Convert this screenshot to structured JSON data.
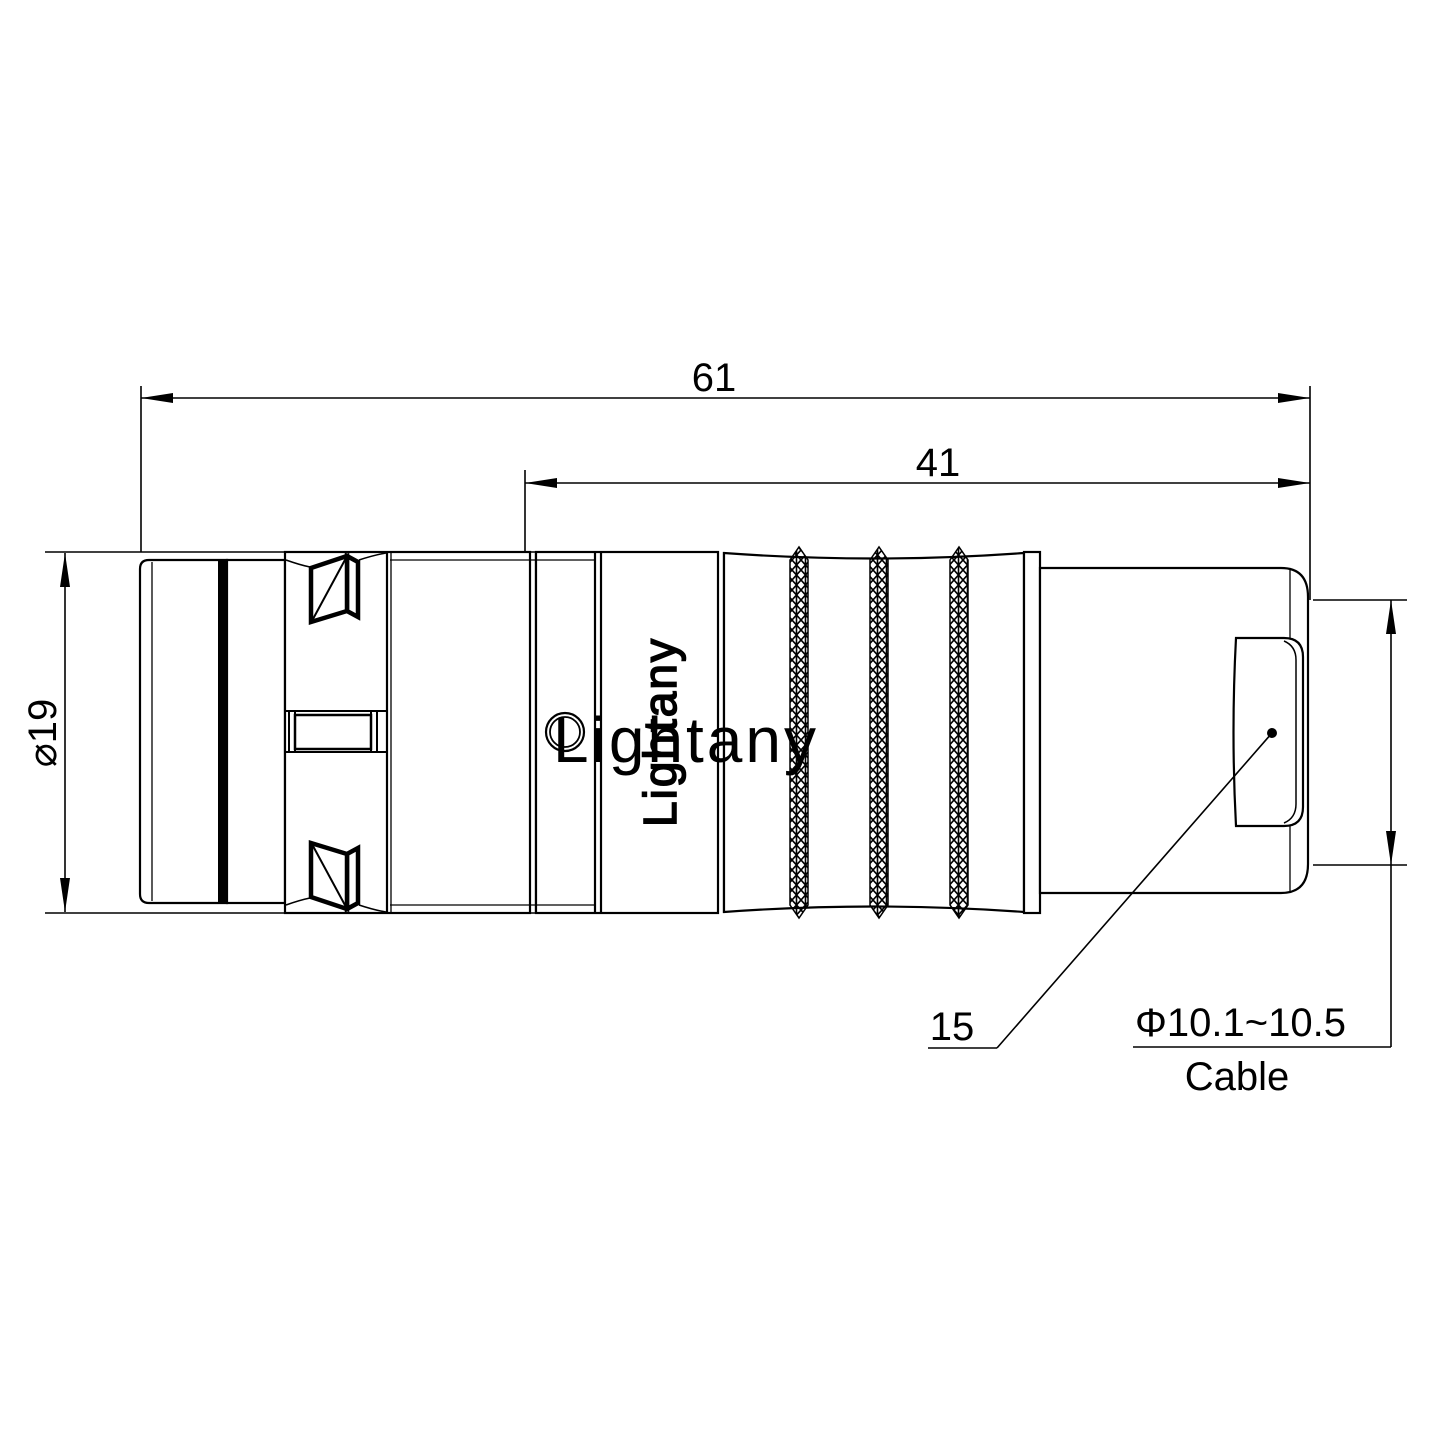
{
  "drawing": {
    "brand_embossed": "Lightany",
    "watermark": "Lightany"
  },
  "dimensions": {
    "total_length": "61",
    "rear_length": "41",
    "outer_diameter": "⌀19",
    "cable_diameter": "Φ10.1~10.5",
    "cable_label": "Cable",
    "part_label": "15"
  },
  "colors": {
    "line": "#000000",
    "watermark": "#f5cdc8",
    "background": "#ffffff"
  }
}
